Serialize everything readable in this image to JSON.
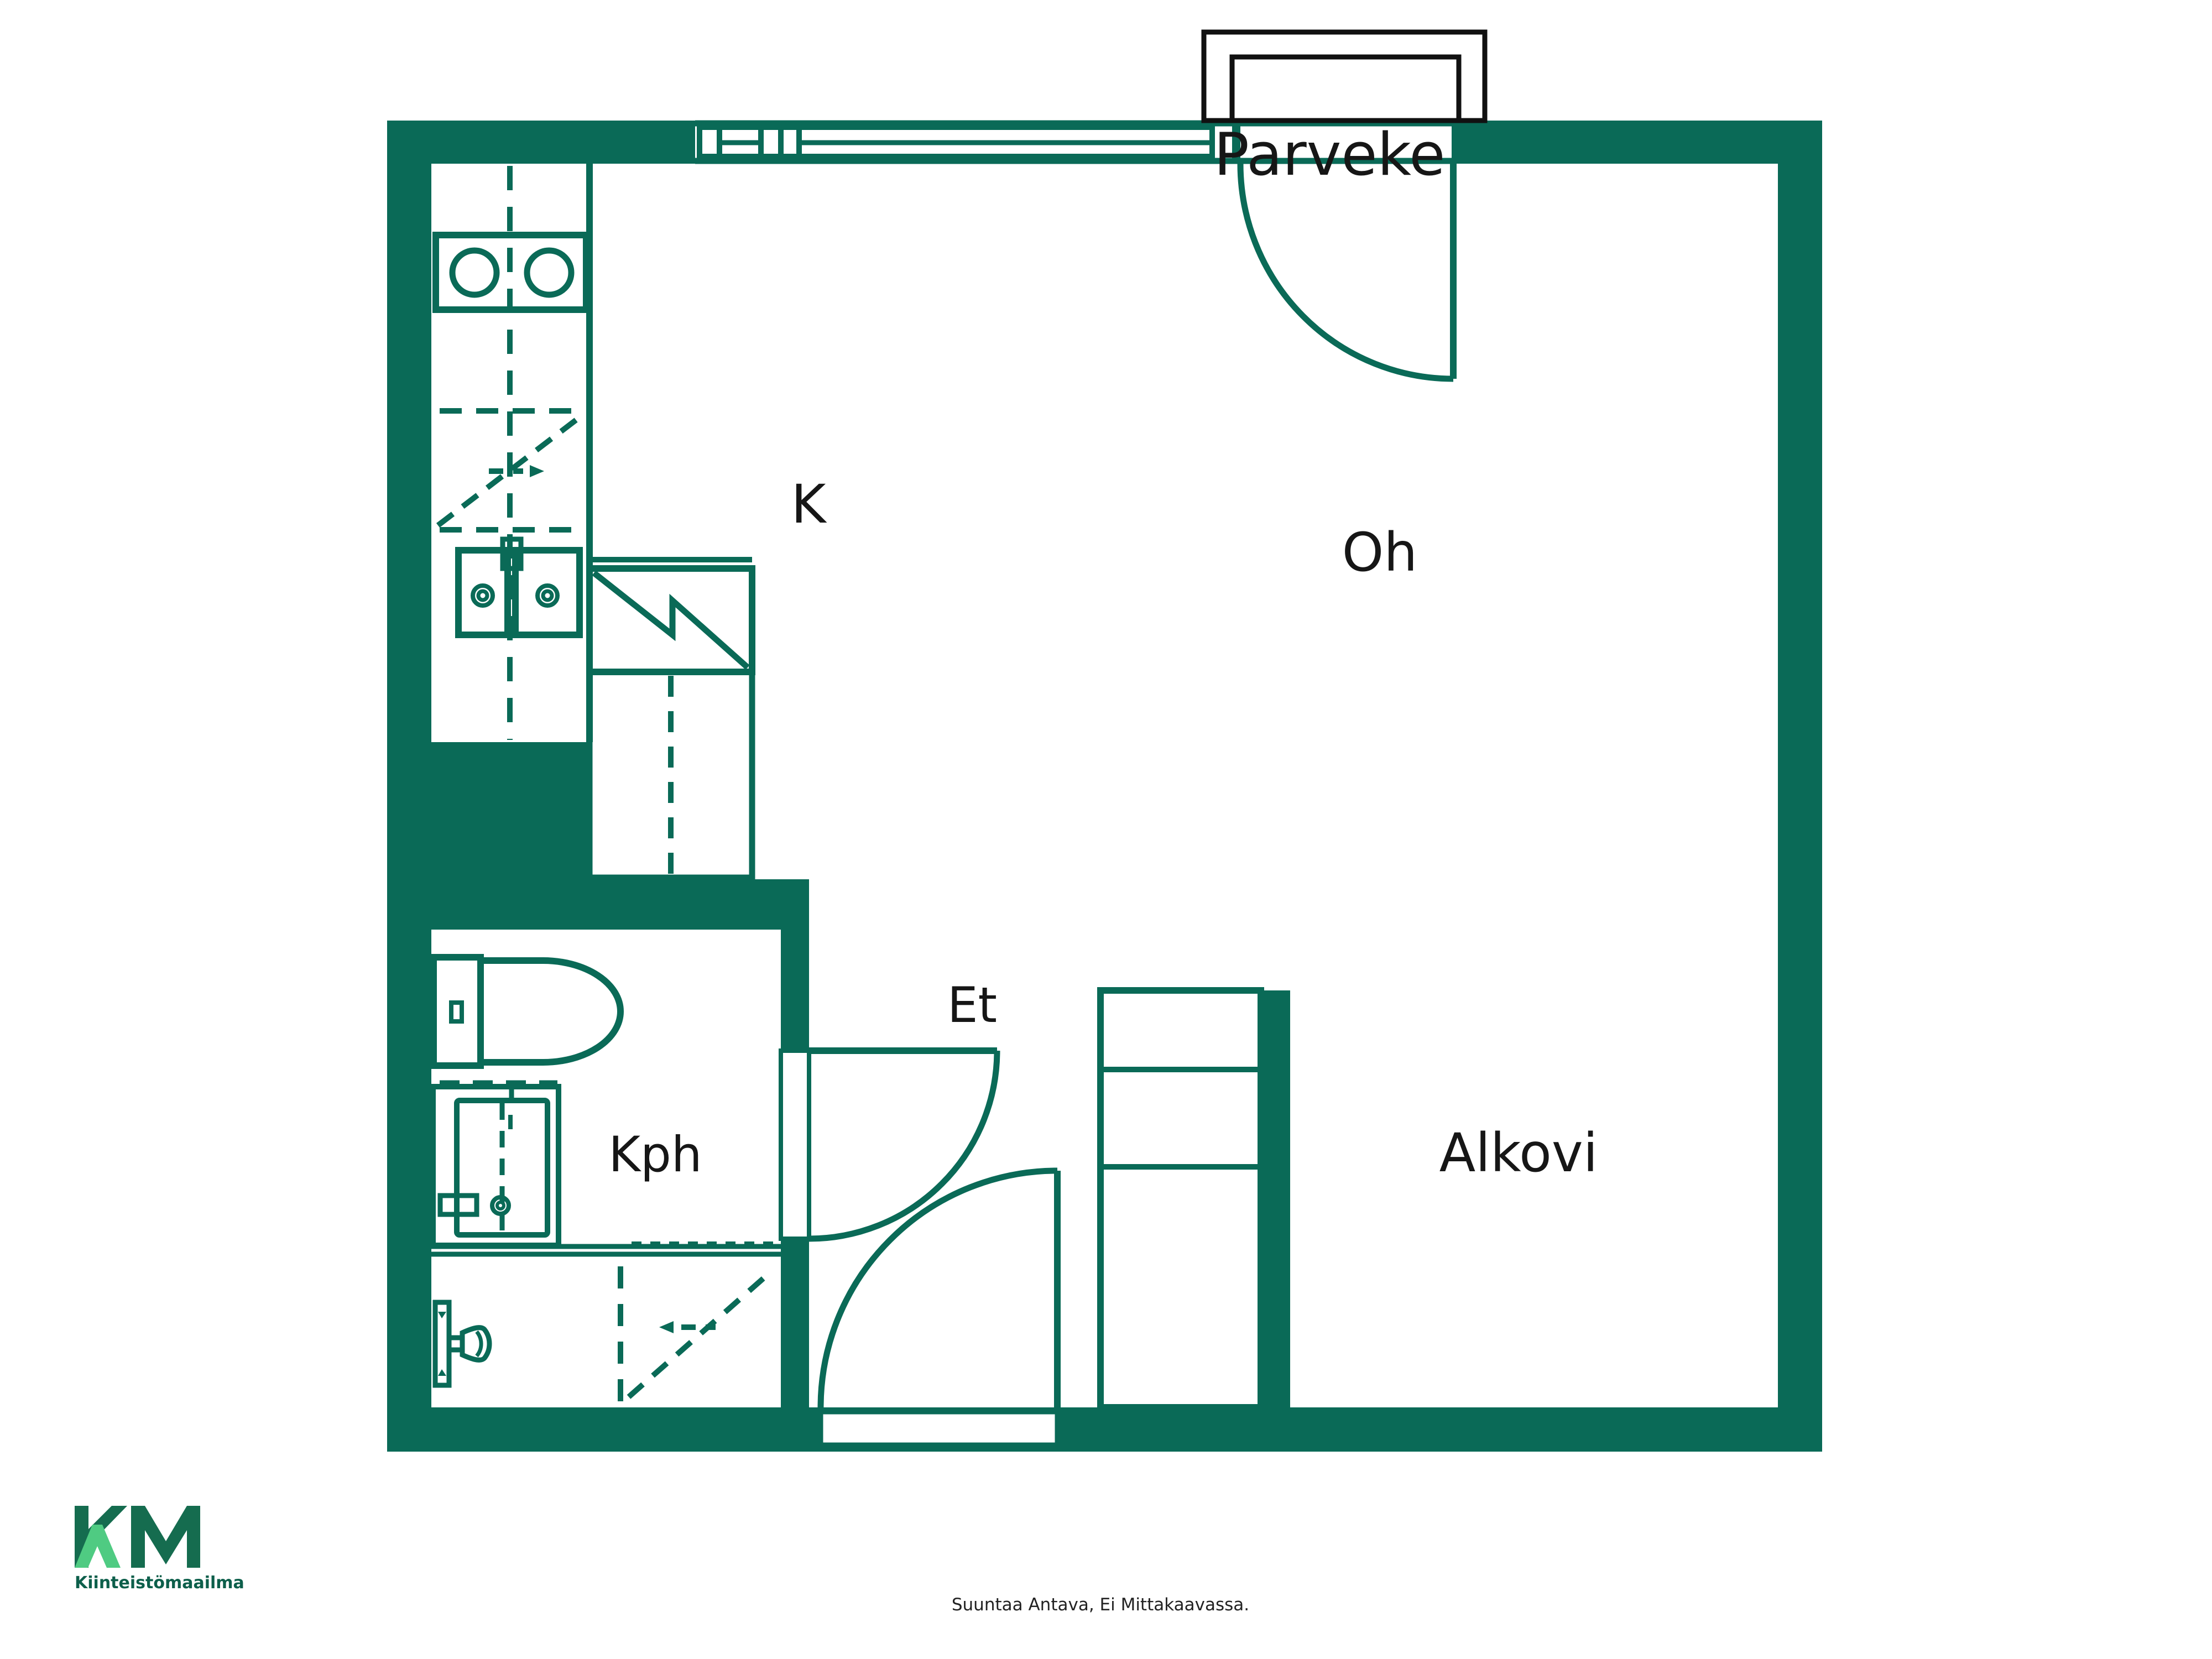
{
  "plan": {
    "labels": {
      "balcony": "Parveke",
      "kitchen": "K",
      "living_room": "Oh",
      "entrance": "Et",
      "bathroom": "Kph",
      "alcove": "Alkovi"
    },
    "fixtures": [
      "stove",
      "kitchen-sink",
      "upper-cabinet-reservation",
      "fridge",
      "toilet",
      "bathroom-sink",
      "shower",
      "appliance-reservation",
      "closet",
      "balcony-door",
      "bathroom-door",
      "front-door",
      "window"
    ],
    "colors": {
      "wall": "#0a6a57",
      "line": "#0a6a57",
      "label": "#161616",
      "balcony_outline": "#111111",
      "logo_dark": "#156c4f",
      "logo_light": "#4fcb82",
      "brand": "#0d5f4b",
      "caption": "#222222"
    }
  },
  "footer": {
    "logo_text": "KM",
    "brand": "Kiinteistömaailma",
    "disclaimer": "Suuntaa Antava, Ei Mittakaavassa."
  }
}
